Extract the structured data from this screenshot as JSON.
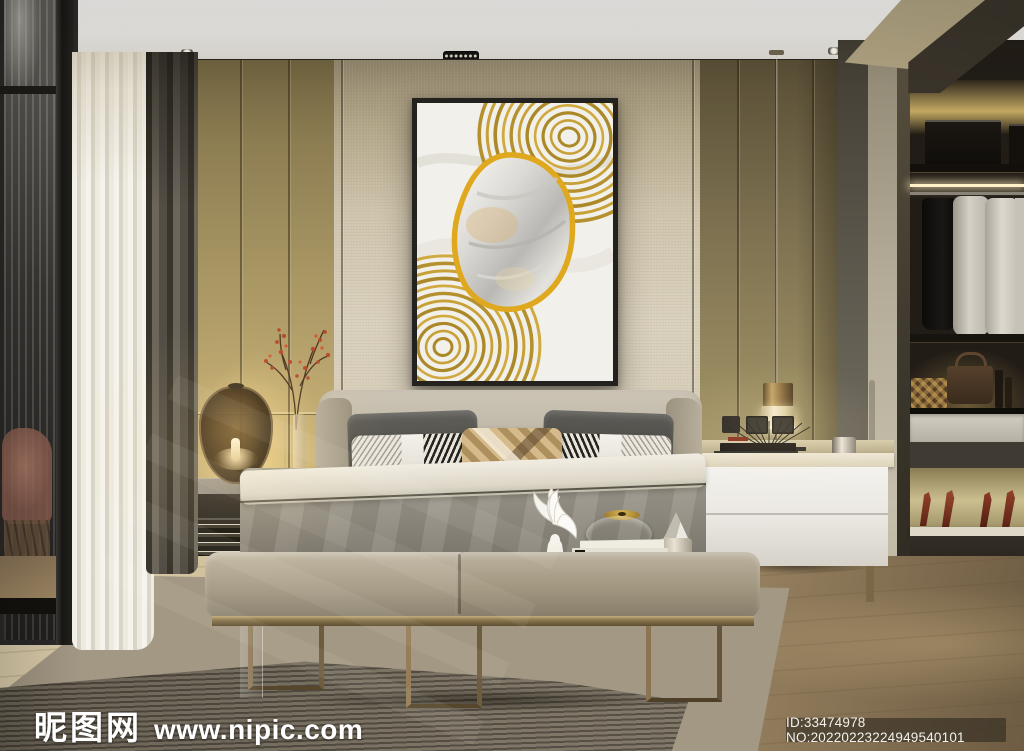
{
  "image": {
    "description": "Photorealistic 3D render of a modern bedroom with bed, art above headboard, walk-in closet and balcony door",
    "width_px": 1024,
    "height_px": 751
  },
  "watermarks": {
    "site_logo": "昵图网",
    "site_url": "www.nipic.com",
    "id_label": "ID:33474978 NO:20220223224949540101"
  },
  "palette": {
    "gold_accent": "#c9a227",
    "emerald_box": "#128a63",
    "wall_linen": "#d6cdbb",
    "wall_gold": "#b3a372",
    "duvet_gray": "#938e84",
    "bench_taupe": "#b3a995",
    "floor_wood": "#c2ad8c",
    "curtain_dark": "#55504a",
    "sheer_white": "#f0ede6",
    "closet_glow": "#d8bd7e",
    "berries_red": "#b5492c",
    "heels_red": "#8a3a26"
  },
  "objects": [
    "framed-abstract-artwork",
    "double-bed",
    "patterned-pillows",
    "gray-duvet",
    "leather-bench",
    "decor-tray",
    "angel-wings-sculpture",
    "emerald-glass-box",
    "crystal-candle-holder",
    "stacked-books",
    "marble-side-table",
    "amber-glass-table-lamp",
    "berry-branch-vase",
    "brass-pendant-light",
    "white-nightstand",
    "wall-outlets",
    "metal-fan-ornament",
    "walk-in-closet",
    "hanging-shirts",
    "storage-boxes",
    "handbag",
    "high-heel-shoes",
    "sheer-curtain",
    "dark-curtain",
    "sliding-glass-door",
    "balcony-lounge-chair",
    "wood-floor",
    "striped-rug",
    "ceiling-downlights",
    "track-spotlight"
  ]
}
